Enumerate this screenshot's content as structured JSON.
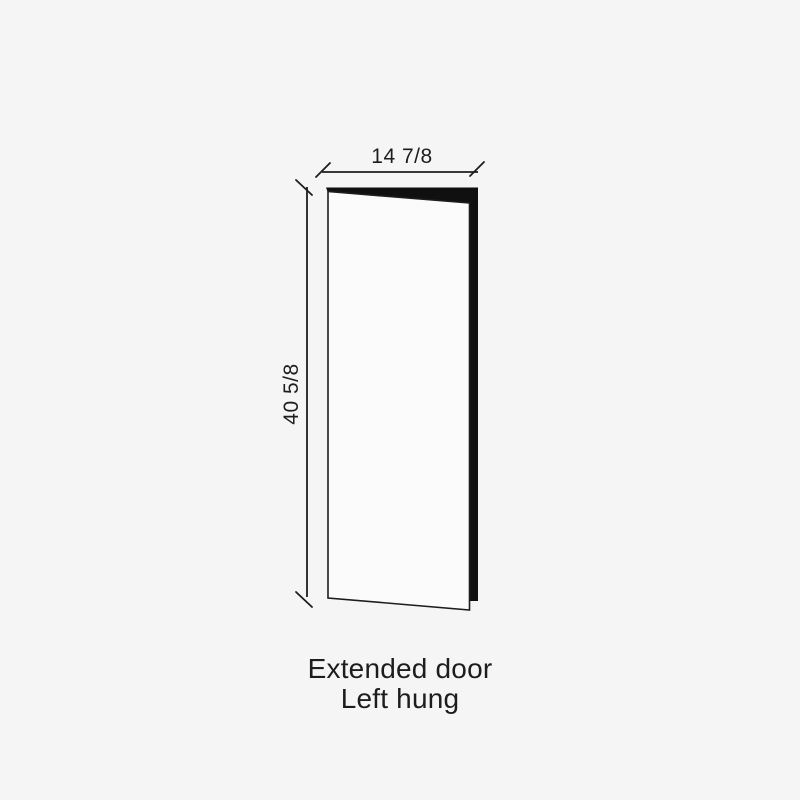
{
  "diagram": {
    "type": "door-dimension-drawing",
    "width_label": "14 7/8",
    "height_label": "40 5/8",
    "caption": {
      "line1": "Extended door",
      "line2": "Left hung"
    },
    "colors": {
      "background": "#f5f5f5",
      "line": "#1d1d1d",
      "edge_fill": "#101010",
      "face_fill": "#fbfbfb",
      "text": "#1d1d1d"
    }
  }
}
